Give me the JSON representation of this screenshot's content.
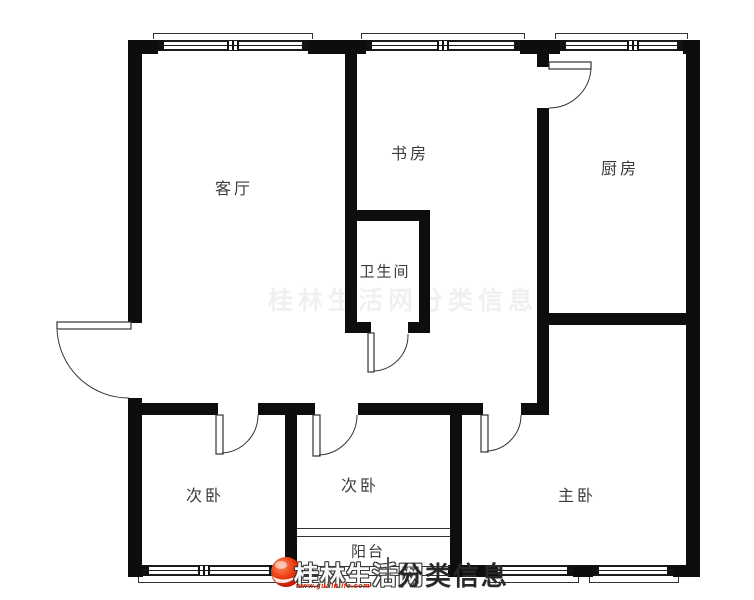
{
  "rooms": {
    "living": {
      "label": "客厅"
    },
    "study": {
      "label": "书房"
    },
    "kitchen": {
      "label": "厨房"
    },
    "bathroom": {
      "label": "卫生间"
    },
    "bedroom_left": {
      "label": "次卧"
    },
    "bedroom_middle": {
      "label": "次卧"
    },
    "bedroom_master": {
      "label": "主卧"
    },
    "balcony": {
      "label": "阳台"
    }
  },
  "watermark": {
    "site": "桂林生活网",
    "separator": "|",
    "section": "分类信息",
    "url": "www.guilinlife.com"
  },
  "ghost_watermark": "桂林生活网分类信息",
  "colors": {
    "wall": "#0d0d0d",
    "line": "#333333",
    "label_text": "#3a3a3a",
    "logo_red": "#e03214",
    "url_red": "#c21d00",
    "watermark_text": "#282828"
  }
}
